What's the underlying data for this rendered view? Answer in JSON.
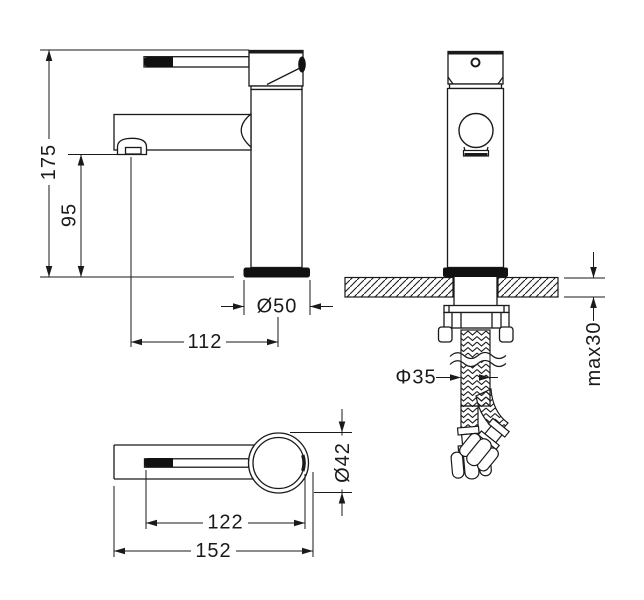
{
  "diagram": {
    "subject": "basin-mixer-faucet-installation-drawing",
    "type": "technical-drawing",
    "line_color": "#1a1a1a",
    "background": "#ffffff",
    "views": {
      "side": {
        "name": "side-view",
        "dims": {
          "total_height": "175",
          "spout_height": "95",
          "spout_reach": "112",
          "base_diameter": "Ø50"
        }
      },
      "front": {
        "name": "front-view",
        "dims": {
          "max_counter_thickness": "max30",
          "mount_hole_diameter": "Φ35"
        }
      },
      "top": {
        "name": "top-view",
        "dims": {
          "body_diameter": "Ø42",
          "handle_length": "122",
          "overall_length": "152"
        }
      }
    }
  }
}
